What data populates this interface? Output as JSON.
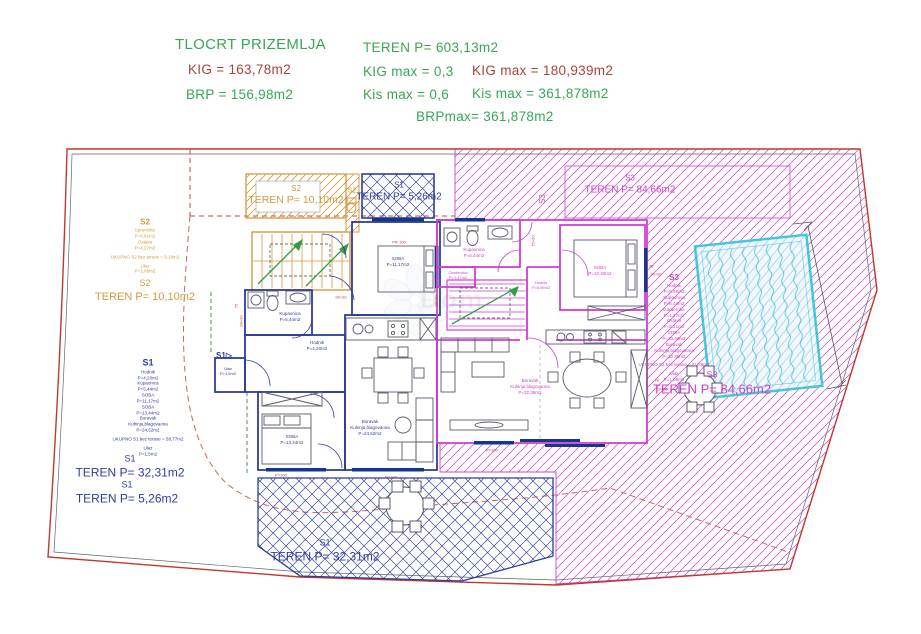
{
  "header": {
    "title": "TLOCRT PRIZEMLJA",
    "kig": "KIG = 163,78m2",
    "brp": "BRP = 156,98m2",
    "teren": "TEREN P= 603,13m2",
    "kig_max_ratio": "KIG max = 0,3",
    "kig_max_area": "KIG max = 180,939m2",
    "kis_max_ratio": "Kis max = 0,6",
    "kis_max_area": "Kis  max = 361,878m2",
    "brp_max": "BRPmax= 361,878m2"
  },
  "colors": {
    "green": "#3aa655",
    "red": "#a8443a",
    "orange": "#d49a3f",
    "blue": "#2e3d9b",
    "magenta": "#cf3fcf",
    "cyan": "#3fc9dc",
    "boundary": "#c0392b",
    "dim": "#cc3333"
  },
  "plan": {
    "labels": [
      {
        "id": "label-s2-info-left",
        "x": 145,
        "y": 246,
        "color": "#d49a3f",
        "lines": [
          {
            "t": "S2",
            "s": 8,
            "b": 1
          },
          {
            "t": "Spremište",
            "s": 4.5
          },
          {
            "t": "P=4,91m2",
            "s": 4.5
          },
          {
            "t": "Ostava",
            "s": 4.5
          },
          {
            "t": "P=4,27m2",
            "s": 4.5
          },
          {
            "t": "UKUPNO S2 bez terase = 9,18m2",
            "s": 4.5,
            "gap": 1
          },
          {
            "t": "Ulaz",
            "s": 4.5,
            "gap": 1
          },
          {
            "t": "P=1,08m2",
            "s": 4.5
          }
        ]
      },
      {
        "id": "label-s2-teren-left",
        "x": 145,
        "y": 291,
        "color": "#d49a3f",
        "lines": [
          {
            "t": "S2",
            "s": 9
          },
          {
            "t": "TEREN P= 10,10m2",
            "s": 11
          }
        ]
      },
      {
        "id": "label-s1-info-left",
        "x": 148,
        "y": 407,
        "color": "#2e3d9b",
        "lines": [
          {
            "t": "S1",
            "s": 9,
            "b": 1
          },
          {
            "t": "Hodnik",
            "s": 4.5
          },
          {
            "t": "P=4,20m2",
            "s": 4.5
          },
          {
            "t": "Kupaonica",
            "s": 4.5
          },
          {
            "t": "P=5,44m2",
            "s": 4.5
          },
          {
            "t": "SOBA",
            "s": 4.5
          },
          {
            "t": "P=11,17m2",
            "s": 4.5
          },
          {
            "t": "SOBA",
            "s": 4.5
          },
          {
            "t": "P=13,44m2",
            "s": 4.5
          },
          {
            "t": "Boravak",
            "s": 4.5
          },
          {
            "t": "Kuhinja,blagovaona",
            "s": 4.5
          },
          {
            "t": "P=24,52m2",
            "s": 4.5
          },
          {
            "t": "UKUPNO S1 bez terase = 58,77m2",
            "s": 4.5,
            "gap": 1
          },
          {
            "t": "Ulaz",
            "s": 4.5,
            "gap": 1
          },
          {
            "t": "P=1,5m2",
            "s": 4.5
          }
        ]
      },
      {
        "id": "label-s1-teren-left-1",
        "x": 130,
        "y": 467,
        "color": "#2e3d9b",
        "lines": [
          {
            "t": "S1",
            "s": 9
          },
          {
            "t": "TEREN P= 32,31m2",
            "s": 12
          }
        ]
      },
      {
        "id": "label-s1-teren-left-2",
        "x": 127,
        "y": 493,
        "color": "#2e3d9b",
        "lines": [
          {
            "t": "S1",
            "s": 9
          },
          {
            "t": "TEREN P= 5,26m2",
            "s": 12
          }
        ]
      },
      {
        "id": "label-s2-teren-top",
        "x": 296,
        "y": 196,
        "color": "#d49a3f",
        "lines": [
          {
            "t": "S2",
            "s": 8
          },
          {
            "t": "TEREN P= 10,10m2",
            "s": 10.5
          }
        ]
      },
      {
        "id": "label-s2-wc",
        "x": 352,
        "y": 191,
        "color": "#d49a3f",
        "lines": [
          {
            "t": "S2",
            "s": 7
          }
        ]
      },
      {
        "id": "label-s1-teren-top",
        "x": 399,
        "y": 192,
        "color": "#2e3d9b",
        "lines": [
          {
            "t": "S1",
            "s": 8
          },
          {
            "t": "TEREN P= 5,26m2",
            "s": 10
          }
        ]
      },
      {
        "id": "label-s3-rot",
        "x": 543,
        "y": 199,
        "rot": -90,
        "color": "#cf3fcf",
        "lines": [
          {
            "t": "S3",
            "s": 8
          }
        ]
      },
      {
        "id": "label-s3-teren-top",
        "x": 630,
        "y": 185,
        "color": "#cf3fcf",
        "lines": [
          {
            "t": "S3",
            "s": 8
          },
          {
            "t": "TEREN P= 84,66m2",
            "s": 10
          }
        ]
      },
      {
        "id": "label-s3-info-right",
        "x": 674,
        "y": 328,
        "color": "#cf3fcf",
        "lines": [
          {
            "t": "S3",
            "s": 8,
            "b": 1
          },
          {
            "t": "Hodnik",
            "s": 4.5
          },
          {
            "t": "P=5,96m2",
            "s": 4.5
          },
          {
            "t": "Kupaonica",
            "s": 4.5
          },
          {
            "t": "P=6,44m2",
            "s": 4.5
          },
          {
            "t": "Garderoba",
            "s": 4.5
          },
          {
            "t": "P=1,47m2",
            "s": 4.5
          },
          {
            "t": "Ostava",
            "s": 4.5
          },
          {
            "t": "P=5,21m2",
            "s": 4.5
          },
          {
            "t": "SOBA",
            "s": 4.5
          },
          {
            "t": "P=10,40m2",
            "s": 4.5
          },
          {
            "t": "Boravak",
            "s": 4.5
          },
          {
            "t": "Kuhinja,blagovaona",
            "s": 4.5
          },
          {
            "t": "P=32,38m2",
            "s": 4.5
          },
          {
            "t": "UKUPNO S3 bez terase = 61,86m2",
            "s": 4.5,
            "gap": 1
          },
          {
            "t": "Ulaz",
            "s": 4.5,
            "gap": 1
          },
          {
            "t": "P=1,08m2",
            "s": 4.5
          }
        ]
      },
      {
        "id": "label-s3-teren-right",
        "x": 712,
        "y": 384,
        "color": "#cf3fcf",
        "lines": [
          {
            "t": "S3",
            "s": 9
          },
          {
            "t": "TEREN P= 84,66m2",
            "s": 13
          }
        ]
      },
      {
        "id": "label-s1-teren-bottom",
        "x": 325,
        "y": 551,
        "color": "#2e3d9b",
        "lines": [
          {
            "t": "S1",
            "s": 9
          },
          {
            "t": "TEREN P= 32,31m2",
            "s": 12
          }
        ]
      },
      {
        "id": "label-s1-marker",
        "x": 224,
        "y": 356,
        "color": "#2e3d9b",
        "lines": [
          {
            "t": "S1▷",
            "s": 8,
            "b": 1
          }
        ]
      },
      {
        "id": "label-kupaonica-s1",
        "x": 290,
        "y": 317,
        "color": "#2e3d9b",
        "lines": [
          {
            "t": "Kupaonica",
            "s": 4.5
          },
          {
            "t": "P=5,44m2",
            "s": 4.5
          }
        ]
      },
      {
        "id": "label-hodnik-s1",
        "x": 317,
        "y": 346,
        "color": "#2e3d9b",
        "lines": [
          {
            "t": "Hodnik",
            "s": 4.5
          },
          {
            "t": "P=4,20m2",
            "s": 4.5
          }
        ]
      },
      {
        "id": "label-ulaz-s1",
        "x": 228,
        "y": 371,
        "color": "#2e3d9b",
        "lines": [
          {
            "t": "Ulaz",
            "s": 4
          },
          {
            "t": "P=1,5m2",
            "s": 4
          }
        ]
      },
      {
        "id": "label-soba1-s1",
        "x": 398,
        "y": 262,
        "color": "#2e3d9b",
        "lines": [
          {
            "t": "SOBA",
            "s": 4.5
          },
          {
            "t": "P=11,17m2",
            "s": 4.5
          }
        ]
      },
      {
        "id": "label-soba2-s1",
        "x": 292,
        "y": 440,
        "color": "#2e3d9b",
        "lines": [
          {
            "t": "SOBA",
            "s": 4.5
          },
          {
            "t": "P=13,44m2",
            "s": 4.5
          }
        ]
      },
      {
        "id": "label-boravak-s1",
        "x": 370,
        "y": 428,
        "color": "#2e3d9b",
        "lines": [
          {
            "t": "Boravak",
            "s": 4.5
          },
          {
            "t": "Kuhinja,blagovaona",
            "s": 4.5
          },
          {
            "t": "P=24,52m2",
            "s": 4.5
          }
        ]
      },
      {
        "id": "label-kupaonica-s3",
        "x": 474,
        "y": 253,
        "color": "#cf3fcf",
        "lines": [
          {
            "t": "Kupaonica",
            "s": 4.5
          },
          {
            "t": "P=6,44m2",
            "s": 4.5
          }
        ]
      },
      {
        "id": "label-garderoba-s3",
        "x": 458,
        "y": 275,
        "color": "#cf3fcf",
        "lines": [
          {
            "t": "Garderoba",
            "s": 4
          },
          {
            "t": "P=1,47m2",
            "s": 4
          }
        ]
      },
      {
        "id": "label-hodnik-s3",
        "x": 541,
        "y": 285,
        "color": "#cf3fcf",
        "lines": [
          {
            "t": "Hodnik",
            "s": 4
          },
          {
            "t": "P=5,96m2",
            "s": 4
          }
        ]
      },
      {
        "id": "label-soba-s3",
        "x": 600,
        "y": 271,
        "color": "#cf3fcf",
        "lines": [
          {
            "t": "SOBA",
            "s": 4.5
          },
          {
            "t": "P=10,40m2",
            "s": 4.5
          }
        ]
      },
      {
        "id": "label-boravak-s3",
        "x": 530,
        "y": 387,
        "color": "#cf3fcf",
        "lines": [
          {
            "t": "Boravak",
            "s": 4.5
          },
          {
            "t": "Kuhinja,blagovaona",
            "s": 4.5
          },
          {
            "t": "P=32,38m2",
            "s": 4.5
          }
        ]
      },
      {
        "id": "watermark-text",
        "x": 452,
        "y": 300,
        "color": "#8d95ab",
        "cls": "wm",
        "lines": [
          {
            "t": "Dom",
            "s": 26
          }
        ]
      },
      {
        "id": "dim-pr100",
        "x": 399,
        "y": 242,
        "color": "#cc3333",
        "lines": [
          {
            "t": "PR-100",
            "s": 4
          }
        ]
      },
      {
        "id": "dim-p100-a",
        "x": 281,
        "y": 475,
        "color": "#cc3333",
        "lines": [
          {
            "t": "P=100",
            "s": 4
          }
        ]
      },
      {
        "id": "dim-p100-b",
        "x": 391,
        "y": 477,
        "color": "#cc3333",
        "lines": [
          {
            "t": "P=100",
            "s": 4
          }
        ]
      },
      {
        "id": "dim-p100-c",
        "x": 492,
        "y": 450,
        "color": "#cc3333",
        "lines": [
          {
            "t": "P=100",
            "s": 4
          }
        ]
      },
      {
        "id": "dim-90-20-a",
        "x": 241,
        "y": 321,
        "rot": -90,
        "color": "#cc3333",
        "lines": [
          {
            "t": "90+20",
            "s": 4
          }
        ]
      },
      {
        "id": "dim-75",
        "x": 236,
        "y": 306,
        "rot": -90,
        "color": "#cc3333",
        "lines": [
          {
            "t": "75",
            "s": 4
          }
        ]
      },
      {
        "id": "dim-90-20-b",
        "x": 341,
        "y": 297,
        "color": "#cc3333",
        "lines": [
          {
            "t": "90+20",
            "s": 4
          }
        ]
      },
      {
        "id": "dim-90-20-c",
        "x": 436,
        "y": 301,
        "rot": -90,
        "color": "#cc3333",
        "lines": [
          {
            "t": "90+20",
            "s": 4
          }
        ]
      },
      {
        "id": "dim-75-20",
        "x": 533,
        "y": 241,
        "rot": -90,
        "color": "#cc3333",
        "lines": [
          {
            "t": "75+20",
            "s": 4
          }
        ]
      },
      {
        "id": "dim-20-a",
        "x": 651,
        "y": 266,
        "color": "#cc3333",
        "lines": [
          {
            "t": "20",
            "s": 4
          }
        ]
      },
      {
        "id": "dim-20-20-a",
        "x": 656,
        "y": 274,
        "color": "#cc3333",
        "lines": [
          {
            "t": "20+20",
            "s": 4
          }
        ]
      },
      {
        "id": "dim-20-b",
        "x": 657,
        "y": 380,
        "color": "#cc3333",
        "lines": [
          {
            "t": "20",
            "s": 4
          }
        ]
      },
      {
        "id": "dim-20-20-b",
        "x": 662,
        "y": 389,
        "color": "#cc3333",
        "lines": [
          {
            "t": "20+20",
            "s": 4
          }
        ]
      }
    ]
  }
}
